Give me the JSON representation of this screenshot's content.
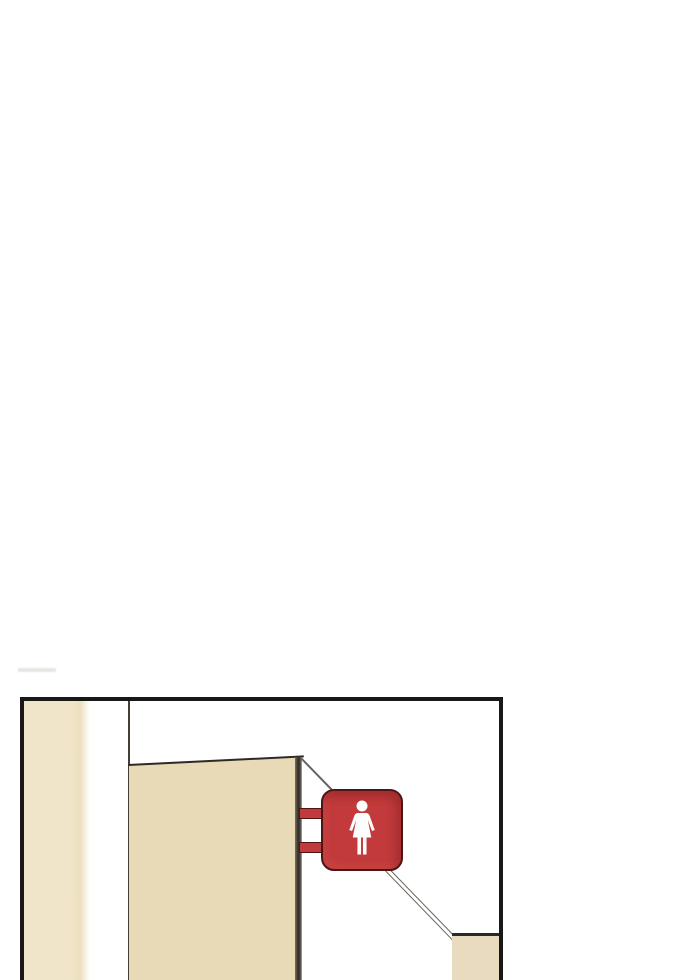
{
  "page": {
    "background": "#ffffff"
  },
  "comic_panel": {
    "kind": "borderless-page webtoon panel",
    "scene": "hallway corner with a women's restroom sign projecting from a wall edge",
    "text": null
  },
  "restroom_sign": {
    "symbol": "female-figure",
    "shape": "rounded-square",
    "mounting": "two side brackets on wall edge"
  },
  "colors": {
    "page-bg": "#ffffff",
    "ink": "#181818",
    "ink-soft": "#2e2923",
    "corner-line": "#453e35",
    "line-gray": "#6a645c",
    "beige-light": "#f1e5c9",
    "beige": "#e9dab7",
    "beige-side": "#e8dbc0",
    "sign-red": "#c23a3b",
    "sign-outline": "#4e1516",
    "icon-white": "#fdfdfd",
    "smudge": "#d6d3cc"
  }
}
